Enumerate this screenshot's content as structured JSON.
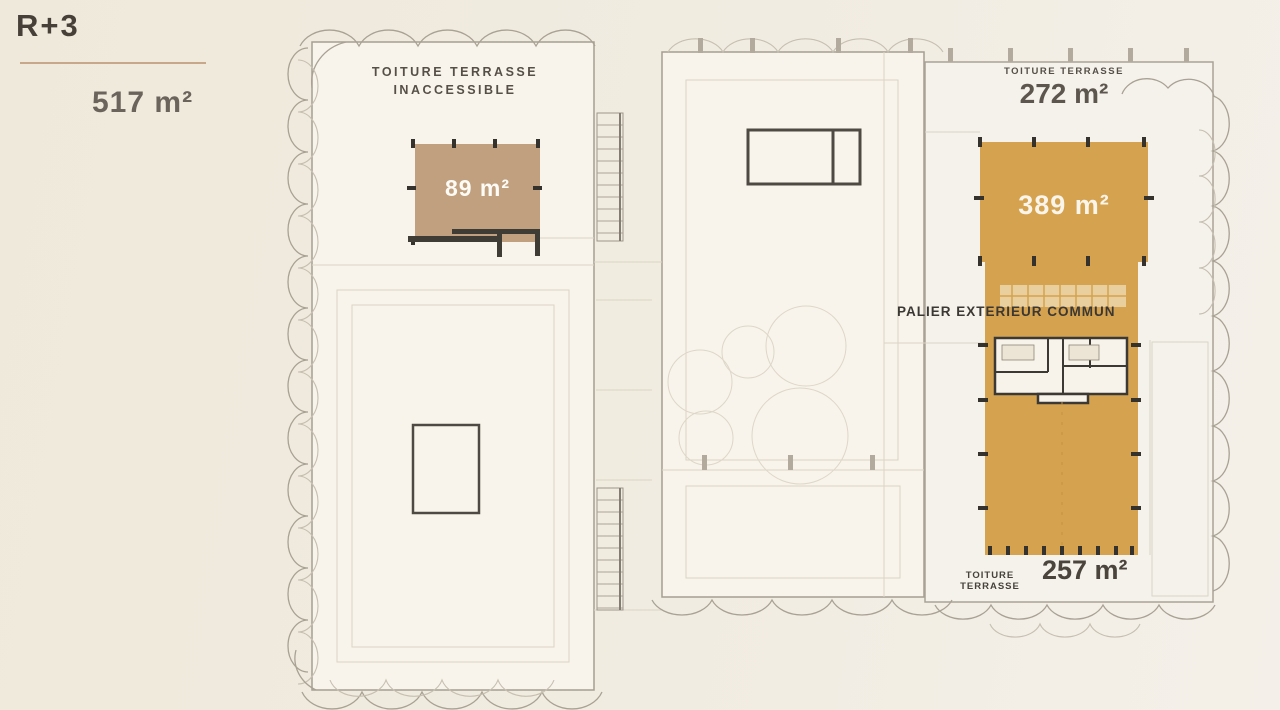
{
  "header": {
    "level": "R+3",
    "total_area": "517 m²"
  },
  "zones": {
    "left_roof": {
      "line1": "TOITURE TERRASSE",
      "line2": "INACCESSIBLE",
      "area": "89 m²"
    },
    "right_top_roof": {
      "label": "TOITURE TERRASSE",
      "area": "272 m²"
    },
    "right_main_terrace": {
      "area": "389 m²"
    },
    "palier": {
      "label": "PALIER EXTERIEUR COMMUN"
    },
    "bottom_roof": {
      "label": "TOITURE TERRASSE",
      "area": "257 m²"
    }
  },
  "colors": {
    "accent_orange": "#d5a24f",
    "accent_tan": "#c0a07f",
    "underline": "#c8a88a",
    "page_background": "#f0eadd"
  }
}
